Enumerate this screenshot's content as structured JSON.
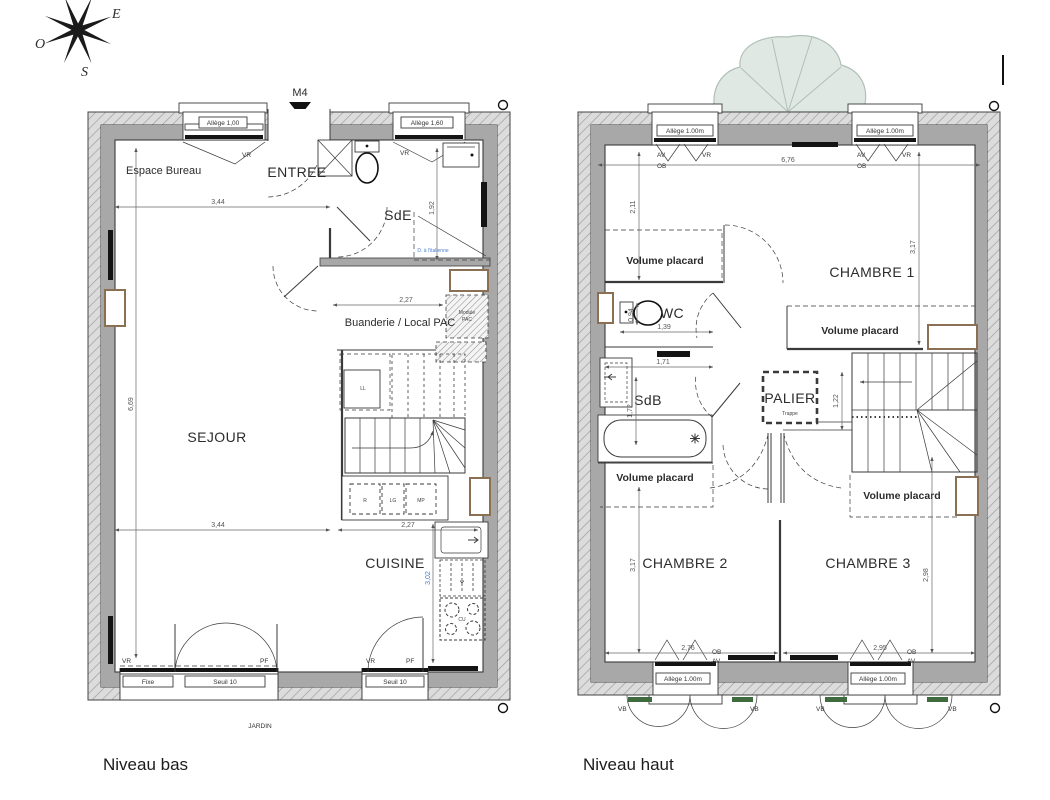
{
  "page": {
    "title_low": "Niveau bas",
    "title_high": "Niveau haut",
    "garden": "JARDIN",
    "entry_marker": "M4"
  },
  "compass": {
    "east": "E",
    "south": "S",
    "west": "O"
  },
  "colors": {
    "wall": "#a8a8a8",
    "hatch_bg": "#dcdcdc",
    "line": "#3a3a3a",
    "accent_blue": "#4a7fd0",
    "tree": "#e0e8e4",
    "frame_brown": "#8a6f52",
    "shutter_green": "#3f6b3f"
  },
  "low": {
    "rooms": {
      "bureau": "Espace Bureau",
      "entree": "ENTREE",
      "sde": "SdE",
      "buanderie": "Buanderie / Local PAC",
      "sejour": "SEJOUR",
      "cuisine": "CUISINE"
    },
    "annotations": {
      "shower": "D. à l'italienne",
      "module_pac_1": "Module",
      "module_pac_2": "PAC",
      "fixe": "Fixe",
      "seuil_1": "Seuil 10",
      "seuil_2": "Seuil 10"
    },
    "windows": {
      "w1_allege": "Allège 1,00",
      "w1_tag": "VR",
      "w2_allege": "Allège 1,60",
      "w2_tag": "VR"
    },
    "doors": {
      "vr_1": "VR",
      "pf_1": "PF",
      "vr_2": "VR",
      "pf_2": "PF"
    },
    "appliances": {
      "r": "R",
      "lg": "LG",
      "mp": "MP",
      "ll": "LL",
      "cu": "CU"
    },
    "dims": {
      "w_sejour_top": "3,44",
      "w_sejour_bottom": "3,44",
      "w_buanderie": "2,27",
      "w_kitchen": "2,27",
      "h_sde": "1,92",
      "h_sejour": "6,69",
      "h_kitchen": "3,02"
    }
  },
  "high": {
    "rooms": {
      "chambre1": "CHAMBRE 1",
      "chambre2": "CHAMBRE 2",
      "chambre3": "CHAMBRE 3",
      "wc": "WC",
      "sdb": "SdB",
      "palier": "PALIER"
    },
    "closets": {
      "c1": "Volume placard",
      "c2": "Volume placard",
      "c3": "Volume placard",
      "c4": "Volume placard"
    },
    "annotations": {
      "trappe": "Trappe"
    },
    "windows": {
      "w1": "Allège 1.00m",
      "w2": "Allège 1.00m",
      "w3": "Allège 1.00m",
      "w4": "Allège 1.00m"
    },
    "tags": {
      "av_1": "AV",
      "vr_1": "VR",
      "ob_1": "OB",
      "av_2": "AV",
      "vr_2": "VR",
      "ob_2": "OB",
      "ob_3": "OB",
      "av_3": "AV",
      "ob_4": "OB",
      "av_4": "AV",
      "vb_1": "VB",
      "vb_2": "VB",
      "vb_3": "VB",
      "vb_4": "VB"
    },
    "dims": {
      "w_total": "6,76",
      "h_left_top": "2,11",
      "h_ch1": "3,17",
      "h_wc": "0,94",
      "w_wc": "1,39",
      "w_hall": "1,71",
      "h_sdb": "1,72",
      "h_palier": "1,22",
      "h_ch2": "3,17",
      "h_ch3": "2,98",
      "w_ch2": "2,76",
      "w_ch3": "2,95"
    }
  }
}
